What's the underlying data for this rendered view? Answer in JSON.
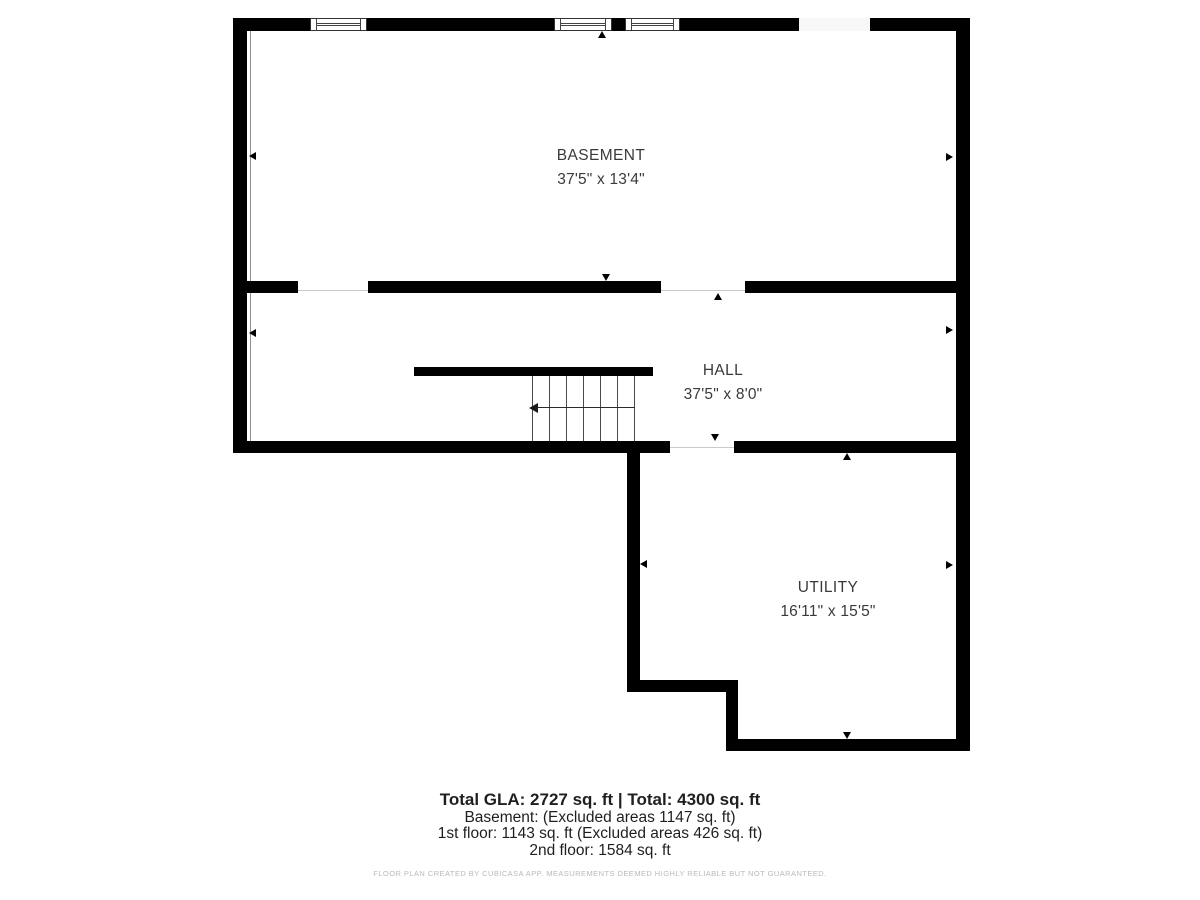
{
  "plan": {
    "rooms": [
      {
        "name": "BASEMENT",
        "dimensions": "37'5\" x 13'4\""
      },
      {
        "name": "HALL",
        "dimensions": "37'5\" x 8'0\""
      },
      {
        "name": "UTILITY",
        "dimensions": "16'11\" x 15'5\""
      }
    ]
  },
  "summary": {
    "total": "Total GLA: 2727 sq. ft | Total: 4300 sq. ft",
    "basement": "Basement: (Excluded areas 1147 sq. ft)",
    "first_floor": "1st floor: 1143 sq. ft (Excluded areas 426 sq. ft)",
    "second_floor": "2nd floor: 1584 sq. ft"
  },
  "disclaimer": "FLOOR PLAN CREATED BY CUBICASA APP. MEASUREMENTS DEEMED HIGHLY RELIABLE BUT NOT GUARANTEED.",
  "colors": {
    "wall": "#000000",
    "room_text": "#3a3a3a",
    "footer_text": "#1f1f1f",
    "disclaimer_text": "#b9b9b9",
    "background": "#ffffff"
  }
}
